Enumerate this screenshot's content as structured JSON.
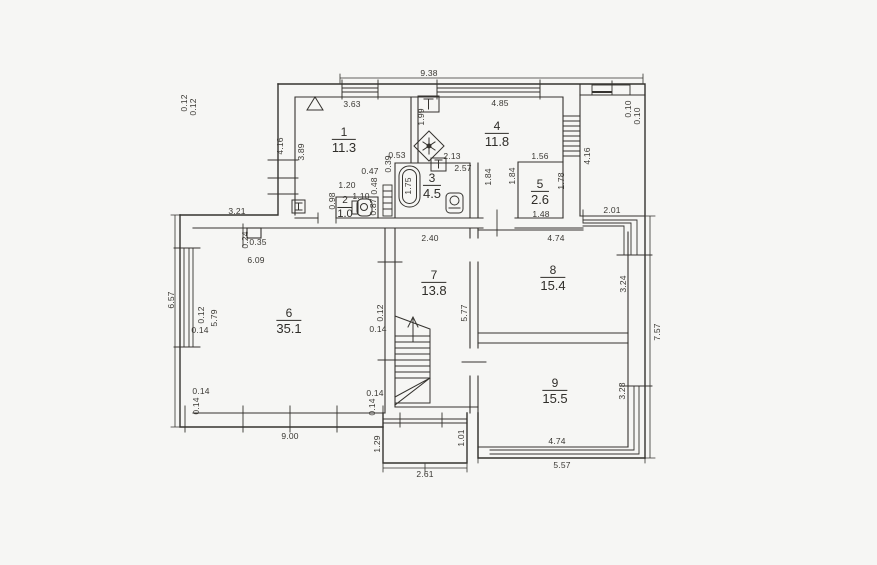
{
  "plan": {
    "kind": "architectural floor plan (scanned)",
    "colors": {
      "paper": "#f6f6f4",
      "ink": "#35332f",
      "label": "#3a3833"
    }
  },
  "rooms": [
    {
      "number": "1",
      "area": "11.3",
      "x": 344,
      "y": 140
    },
    {
      "number": "2",
      "area": "1.0",
      "x": 345,
      "y": 208,
      "sm": 1
    },
    {
      "number": "3",
      "area": "4.5",
      "x": 432,
      "y": 186
    },
    {
      "number": "4",
      "area": "11.8",
      "x": 497,
      "y": 134
    },
    {
      "number": "5",
      "area": "2.6",
      "x": 540,
      "y": 192
    },
    {
      "number": "6",
      "area": "35.1",
      "x": 289,
      "y": 321
    },
    {
      "number": "7",
      "area": "13.8",
      "x": 434,
      "y": 283
    },
    {
      "number": "8",
      "area": "15.4",
      "x": 553,
      "y": 278
    },
    {
      "number": "9",
      "area": "15.5",
      "x": 555,
      "y": 391
    }
  ],
  "dimensions": [
    {
      "t": "9.38",
      "x": 429,
      "y": 73
    },
    {
      "t": "0.12",
      "x": 184,
      "y": 103,
      "v": 1
    },
    {
      "t": "0.12",
      "x": 193,
      "y": 107,
      "v": 1
    },
    {
      "t": "3.63",
      "x": 352,
      "y": 104
    },
    {
      "t": "4.85",
      "x": 500,
      "y": 103
    },
    {
      "t": "0.10",
      "x": 628,
      "y": 109,
      "v": 1
    },
    {
      "t": "0.10",
      "x": 637,
      "y": 116,
      "v": 1
    },
    {
      "t": "1.99",
      "x": 421,
      "y": 117,
      "v": 1
    },
    {
      "t": "4.16",
      "x": 280,
      "y": 146,
      "v": 1
    },
    {
      "t": "3.89",
      "x": 301,
      "y": 152,
      "v": 1
    },
    {
      "t": "4.16",
      "x": 587,
      "y": 156,
      "v": 1
    },
    {
      "t": "0.53",
      "x": 397,
      "y": 155
    },
    {
      "t": "2.13",
      "x": 452,
      "y": 156
    },
    {
      "t": "0.39",
      "x": 388,
      "y": 164,
      "v": 1
    },
    {
      "t": "0.47",
      "x": 370,
      "y": 171
    },
    {
      "t": "2.57",
      "x": 463,
      "y": 168
    },
    {
      "t": "1.56",
      "x": 540,
      "y": 156
    },
    {
      "t": "1.84",
      "x": 488,
      "y": 177,
      "v": 1
    },
    {
      "t": "1.84",
      "x": 512,
      "y": 176,
      "v": 1
    },
    {
      "t": "1.78",
      "x": 561,
      "y": 181,
      "v": 1
    },
    {
      "t": "0.48",
      "x": 374,
      "y": 186,
      "v": 1
    },
    {
      "t": "1.20",
      "x": 347,
      "y": 185
    },
    {
      "t": "0.98",
      "x": 332,
      "y": 201,
      "v": 1
    },
    {
      "t": "1.10",
      "x": 361,
      "y": 196
    },
    {
      "t": "0.87",
      "x": 373,
      "y": 207,
      "v": 1
    },
    {
      "t": "1.75",
      "x": 408,
      "y": 186,
      "v": 1
    },
    {
      "t": "1.48",
      "x": 541,
      "y": 214
    },
    {
      "t": "2.01",
      "x": 612,
      "y": 210
    },
    {
      "t": "3.21",
      "x": 237,
      "y": 211
    },
    {
      "t": "0.24",
      "x": 245,
      "y": 240,
      "v": 1
    },
    {
      "t": "0.35",
      "x": 258,
      "y": 242
    },
    {
      "t": "6.09",
      "x": 256,
      "y": 260
    },
    {
      "t": "2.40",
      "x": 430,
      "y": 238
    },
    {
      "t": "4.74",
      "x": 556,
      "y": 238
    },
    {
      "t": "3.24",
      "x": 623,
      "y": 284,
      "v": 1
    },
    {
      "t": "6.57",
      "x": 171,
      "y": 300,
      "v": 1
    },
    {
      "t": "0.12",
      "x": 201,
      "y": 315,
      "v": 1
    },
    {
      "t": "0.14",
      "x": 200,
      "y": 330
    },
    {
      "t": "5.79",
      "x": 214,
      "y": 318,
      "v": 1
    },
    {
      "t": "0.12",
      "x": 380,
      "y": 313,
      "v": 1
    },
    {
      "t": "0.14",
      "x": 378,
      "y": 329
    },
    {
      "t": "5.77",
      "x": 464,
      "y": 313,
      "v": 1
    },
    {
      "t": "7.57",
      "x": 657,
      "y": 332,
      "v": 1
    },
    {
      "t": "0.14",
      "x": 201,
      "y": 391
    },
    {
      "t": "0.14",
      "x": 196,
      "y": 406,
      "v": 1
    },
    {
      "t": "0.14",
      "x": 375,
      "y": 393
    },
    {
      "t": "0.14",
      "x": 372,
      "y": 407,
      "v": 1
    },
    {
      "t": "9.00",
      "x": 290,
      "y": 436
    },
    {
      "t": "1.29",
      "x": 377,
      "y": 444,
      "v": 1
    },
    {
      "t": "1.01",
      "x": 461,
      "y": 438,
      "v": 1
    },
    {
      "t": "2.61",
      "x": 425,
      "y": 474
    },
    {
      "t": "3.28",
      "x": 622,
      "y": 391,
      "v": 1
    },
    {
      "t": "4.74",
      "x": 557,
      "y": 441
    },
    {
      "t": "5.57",
      "x": 562,
      "y": 465
    }
  ],
  "fixtures": [
    {
      "name": "roof-vent-triangle"
    },
    {
      "name": "boiler-h-box"
    },
    {
      "name": "toilet-wc-small"
    },
    {
      "name": "bathtub"
    },
    {
      "name": "washbasin-bathroom"
    },
    {
      "name": "toilet-bathroom"
    },
    {
      "name": "washbasin-kitchen"
    },
    {
      "name": "extract-fan-diamond"
    },
    {
      "name": "staircase-up-arrow"
    },
    {
      "name": "porch-window"
    }
  ]
}
